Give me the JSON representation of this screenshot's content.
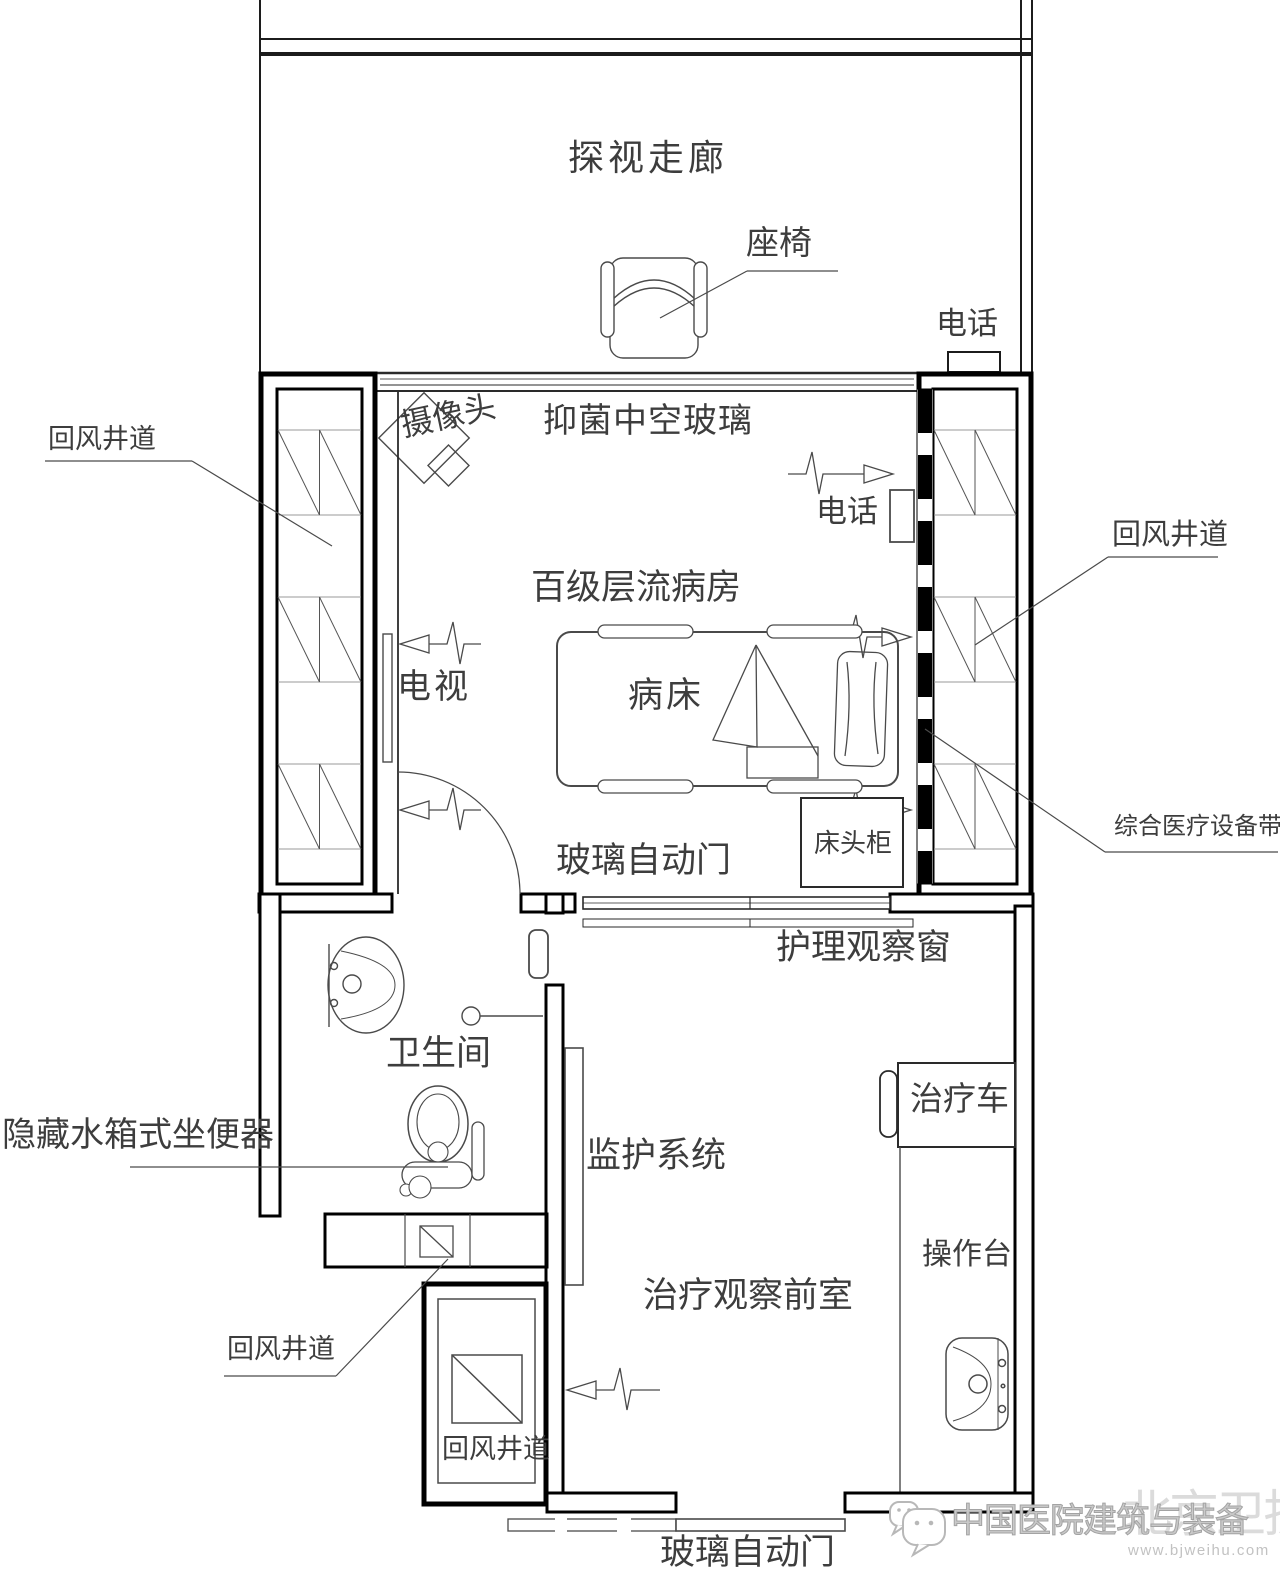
{
  "corridor": {
    "label": "探视走廊",
    "seat_label": "座椅",
    "phone_label": "电话"
  },
  "ward": {
    "label": "百级层流病房",
    "camera_label": "摄像头",
    "glass_label": "抑菌中空玻璃",
    "tv_label": "电视",
    "phone_label": "电话",
    "bed_label": "病床",
    "cabinet_label": "床头柜",
    "door_label": "玻璃自动门"
  },
  "shafts": {
    "left_label": "回风井道",
    "right_label": "回风井道",
    "bottom_left_label": "回风井道",
    "bottom_shaft_label": "回风井道",
    "equipment_belt_label": "综合医疗设备带"
  },
  "bathroom": {
    "label": "卫生间",
    "toilet_label": "隐藏水箱式坐便器"
  },
  "anteroom": {
    "label": "治疗观察前室",
    "window_label": "护理观察窗",
    "monitor_label": "监护系统",
    "cart_label": "治疗车",
    "worktop_label": "操作台",
    "door_label": "玻璃自动门"
  },
  "watermark": {
    "brand": "中国医院建筑与装备",
    "overlay": "北京卫护",
    "url": "www.bjweihu.com"
  },
  "colors": {
    "wall": "#111111",
    "line": "#4a4a4a",
    "text": "#3d3d3d",
    "watermark": "#c9c9c9"
  }
}
